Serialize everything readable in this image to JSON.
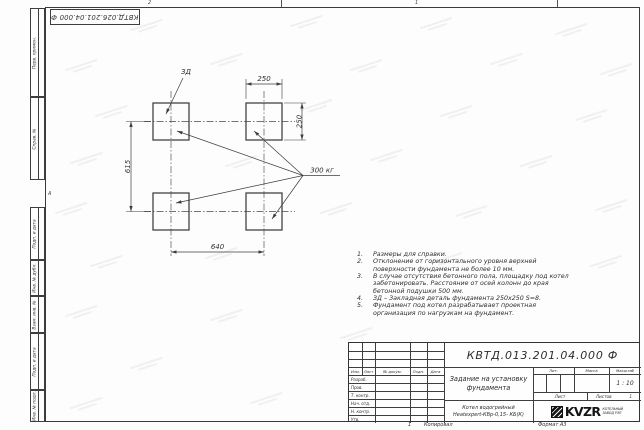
{
  "frame": {
    "top_stamp": "КВТД.026.201.04.000 Ф",
    "zone_top_left": "2",
    "zone_top_right": "1",
    "zone_left": "А",
    "side_columns": [
      "Перв. примен.",
      "Справ. №",
      "Подп. и дата",
      "Инв. № дубл.",
      "Взам. инв. №",
      "Подп. и дата",
      "Инв. № подл."
    ]
  },
  "drawing": {
    "embed_label": "ЗД",
    "load_label": "300 кг",
    "dim_width_top": "250",
    "dim_height_right": "250",
    "dim_vertical_left": "615",
    "dim_horizontal_bottom": "640"
  },
  "notes": [
    {
      "num": "1.",
      "text": "Размеры для справки."
    },
    {
      "num": "2.",
      "text": "Отклонение от горизонтального уровня верхней поверхности фундамента не более 10 мм."
    },
    {
      "num": "3.",
      "text": "В случае отсутствия бетонного пола, площадку под котел забетонировать. Расстояние от осей колонн до края бетонной подушки 500 мм."
    },
    {
      "num": "4.",
      "text": "ЗД – Закладная деталь фундамента 250х250 S=8."
    },
    {
      "num": "5.",
      "text": "Фундамент под котел разрабатывает проектная организация по нагрузкам на фундамент."
    }
  ],
  "title_block": {
    "designation": "КВТД.013.201.04.000 Ф",
    "doc_title": "Задание на установку фундамента",
    "product_line1": "Котел водогрейный",
    "product_line2": "Heatexpert-КВр-0,15- КБ(К)",
    "col_izm": "Изм.",
    "col_list": "Лист",
    "col_docnum": "№ докум.",
    "col_podp": "Подп.",
    "col_data": "Дата",
    "row_razrab": "Разраб.",
    "row_prov": "Пров.",
    "row_tkontr": "Т. контр.",
    "row_nachotd": "Нач. отд.",
    "row_nkontr": "Н. контр.",
    "row_utv": "Утв.",
    "lit_label": "Лит.",
    "mass_label": "Масса",
    "scale_label": "Масштаб",
    "scale_value": "1 : 10",
    "sheet_label": "Лист",
    "sheets_label": "Листов",
    "sheets_value": "1",
    "logo_text": "KVZR",
    "logo_caption1": "КОТЕЛЬНЫЙ",
    "logo_caption2": "ЗАВОД РЭП"
  },
  "footer": {
    "num": "1",
    "copied": "Копировал",
    "format": "Формат А3"
  }
}
